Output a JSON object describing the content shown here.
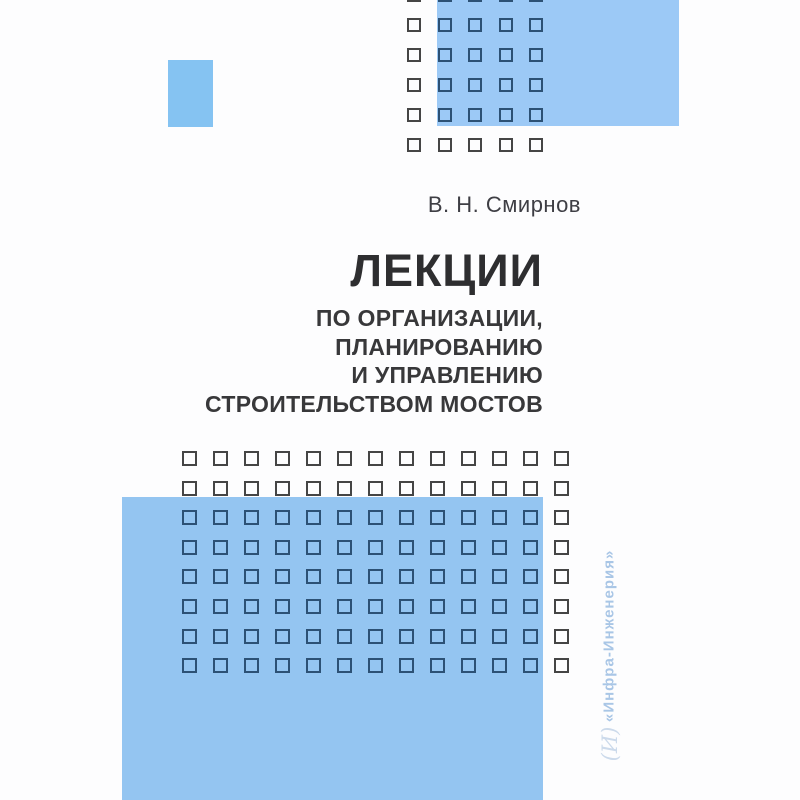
{
  "cover": {
    "author": "В. Н. Смирнов",
    "title": "ЛЕКЦИИ",
    "subtitle_lines": [
      "ПО ОРГАНИЗАЦИИ,",
      "ПЛАНИРОВАНИЮ",
      "И УПРАВЛЕНИЮ",
      "СТРОИТЕЛЬСТВОМ МОСТОВ"
    ],
    "publisher": "«Инфра-Инженерия»",
    "publisher_logo": "(И)"
  },
  "colors": {
    "page_background": "#fdfdfe",
    "accent_blue_top_rect": "#9cc9f6",
    "accent_blue_small_rect": "#85c3f2",
    "accent_blue_bottom_rect": "#94c5f1",
    "square_outline_on_blue": "#2c5175",
    "square_outline_on_white": "#454545",
    "title_text": "#2e2e30",
    "subtitle_text": "#38383a",
    "author_text": "#3e3e44",
    "publisher_text": "#a9c6e6"
  },
  "decor": {
    "rects": [
      {
        "name": "top-right-blue-rect",
        "x": 437,
        "y": -20,
        "w": 242,
        "h": 146,
        "color": "#9cc9f6"
      },
      {
        "name": "small-left-blue-rect",
        "x": 168,
        "y": 60,
        "w": 45,
        "h": 67,
        "color": "#85c3f2"
      },
      {
        "name": "bottom-left-blue-rect",
        "x": 122,
        "y": 497,
        "w": 421,
        "h": 303,
        "color": "#94c5f1"
      }
    ],
    "grids": [
      {
        "name": "top-square-grid",
        "x": 407,
        "y": -12,
        "cols": 5,
        "rows": 6,
        "stepX": 30.6,
        "stepY": 30,
        "size": 14,
        "border": 2.5,
        "colorOnBlue": "#2c5175",
        "colorOnWhite": "#454545"
      },
      {
        "name": "main-square-grid",
        "x": 182,
        "y": 451,
        "cols": 13,
        "rows": 8,
        "stepX": 31,
        "stepY": 29.6,
        "size": 15,
        "border": 2.5,
        "colorOnBlue": "#2c5175",
        "colorOnWhite": "#454545"
      }
    ]
  }
}
